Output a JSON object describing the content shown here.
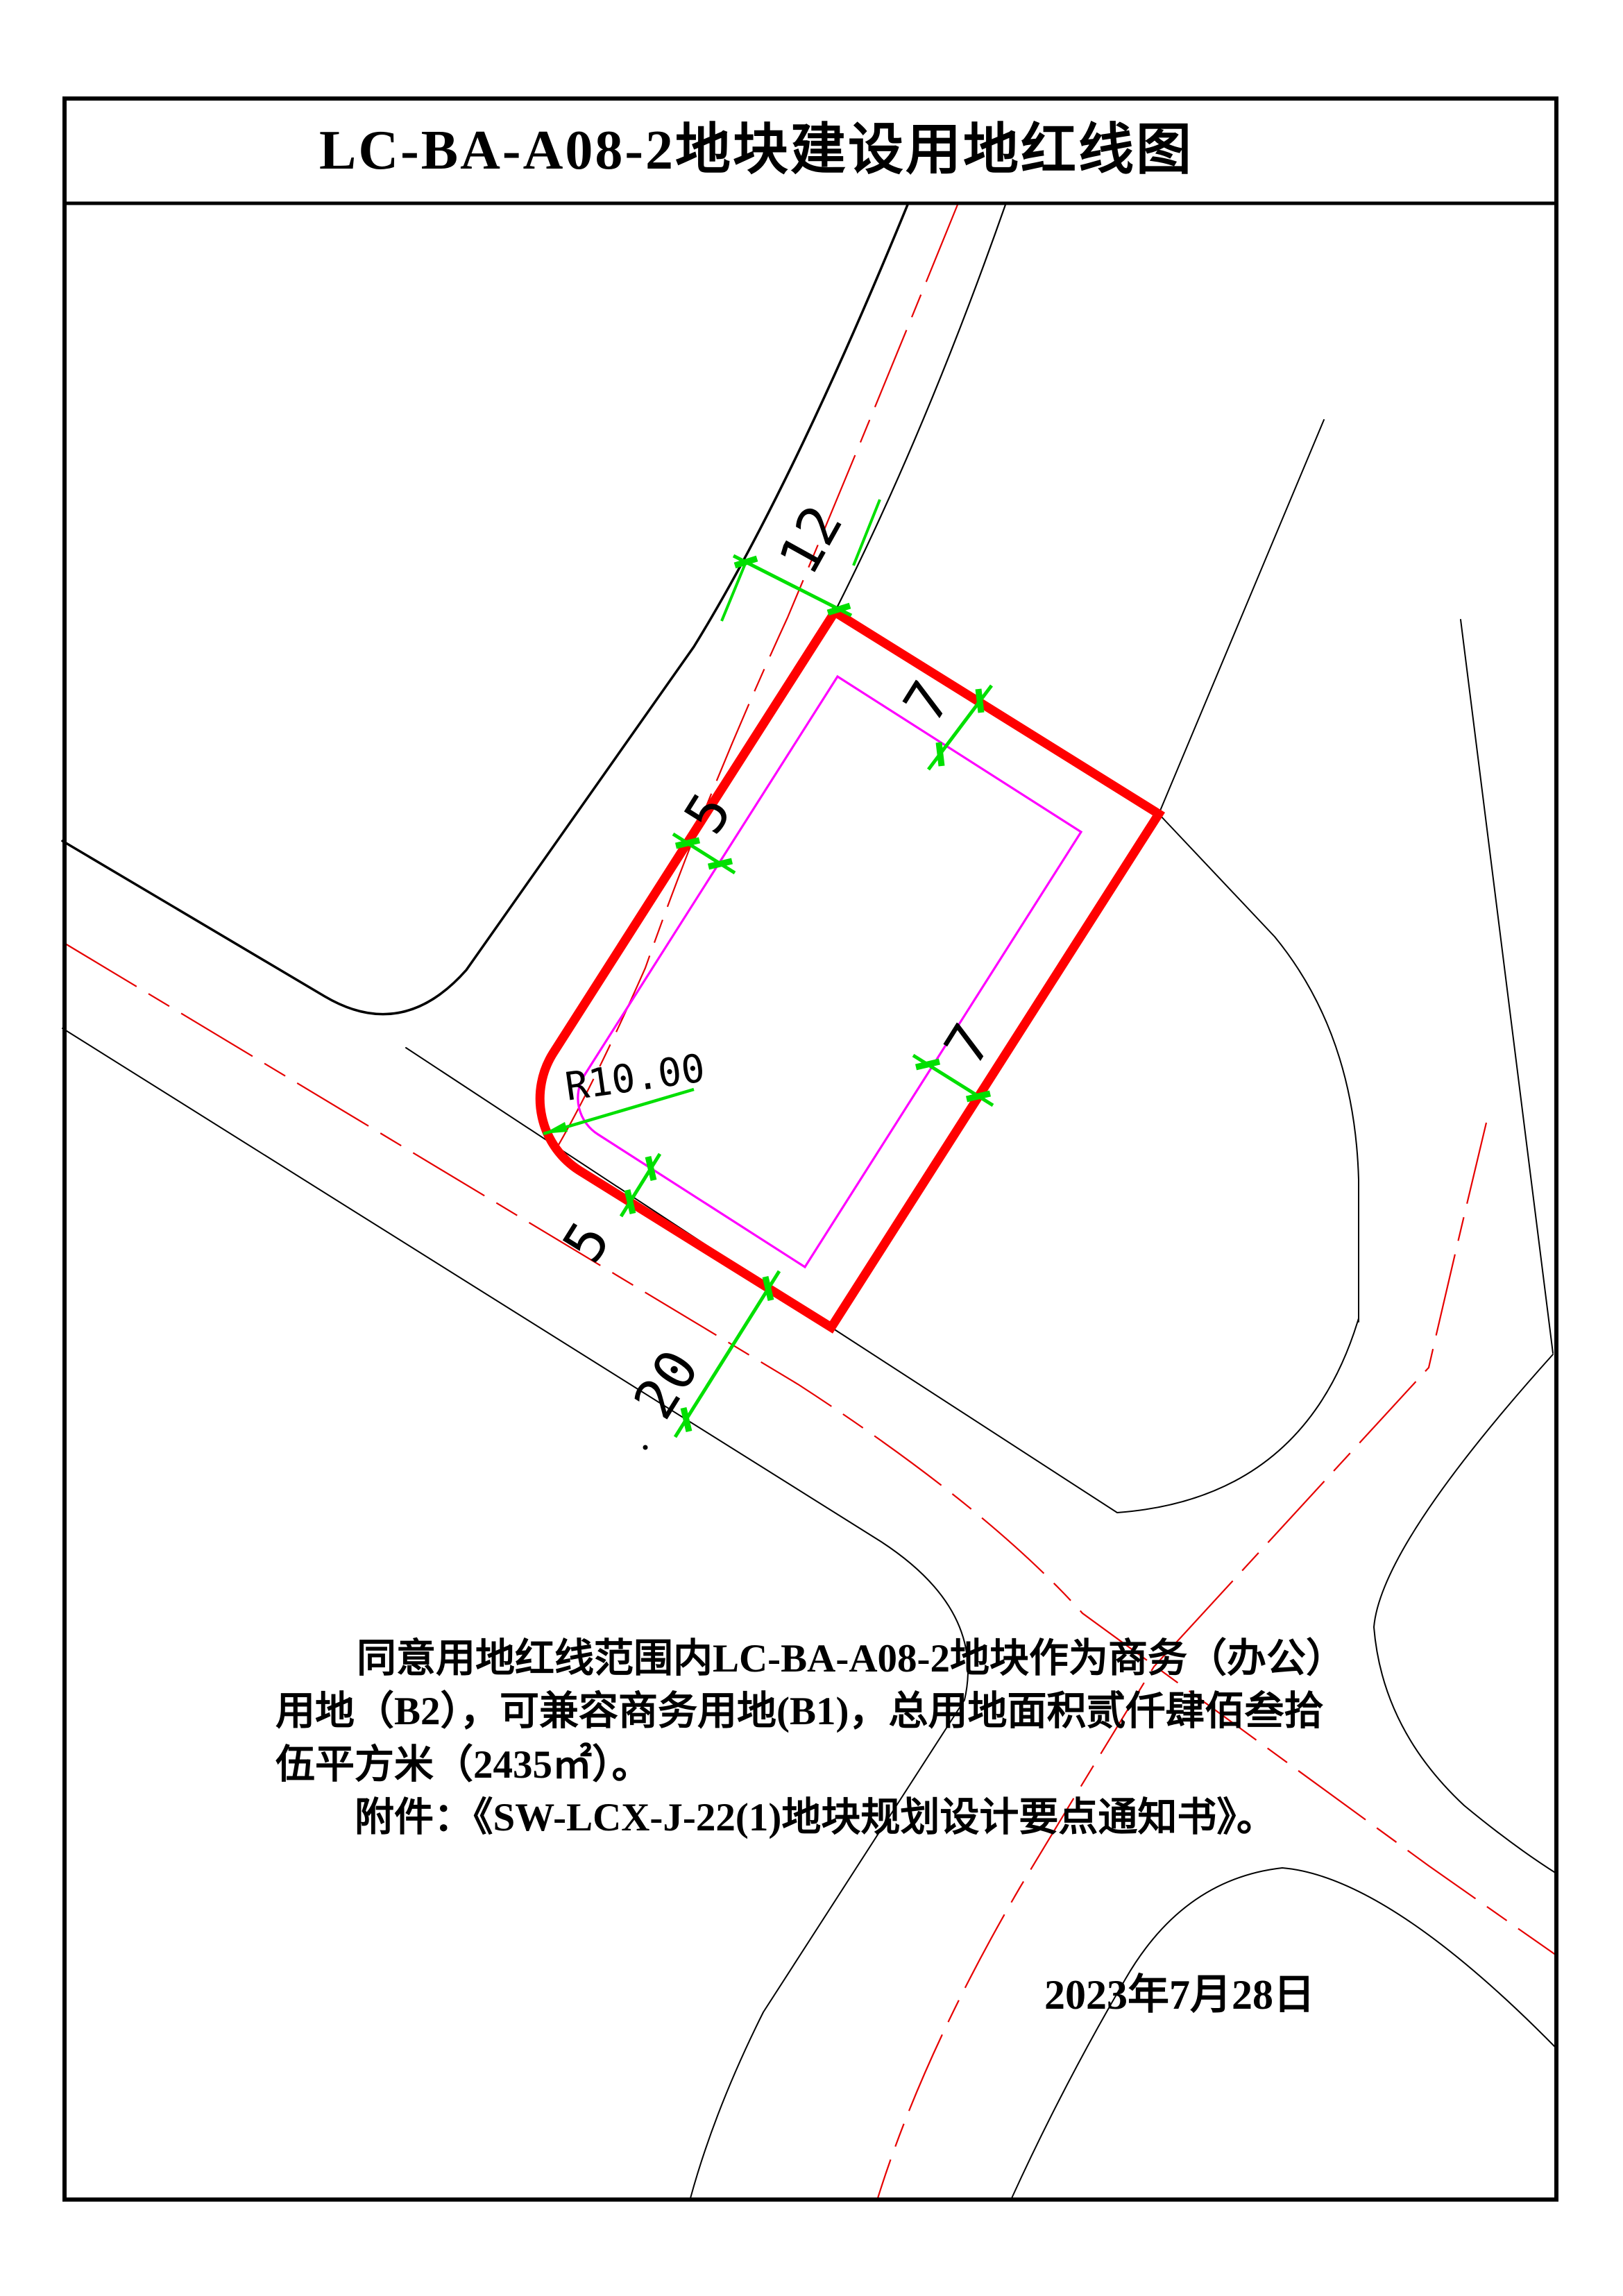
{
  "page": {
    "title": "LC-BA-A08-2地块建设用地红线图",
    "date": "2023年7月28日"
  },
  "dimensions": {
    "top_road_width": "12",
    "north_setback": "7",
    "northwest_setback": "5",
    "southeast_setback": "7",
    "southwest_setback": "5",
    "bottom_road_width": "20",
    "corner_radius": "R10.00"
  },
  "notes": {
    "line1": "同意用地红线范围内LC-BA-A08-2地块作为商务（办公）",
    "line2": "用地（B2），可兼容商务用地(B1)，总用地面积贰仟肆佰叁拾",
    "line3": "伍平方米（2435㎡）。",
    "line4": "附件：《SW-LCX-J-22(1)地块规划设计要点通知书》。"
  },
  "colors": {
    "red_line_boundary": "#FF0000",
    "setback_line": "#FF00FF",
    "dimension_green": "#00DF00",
    "road_centerline_red": "#E60000",
    "drawing_black": "#000000"
  }
}
